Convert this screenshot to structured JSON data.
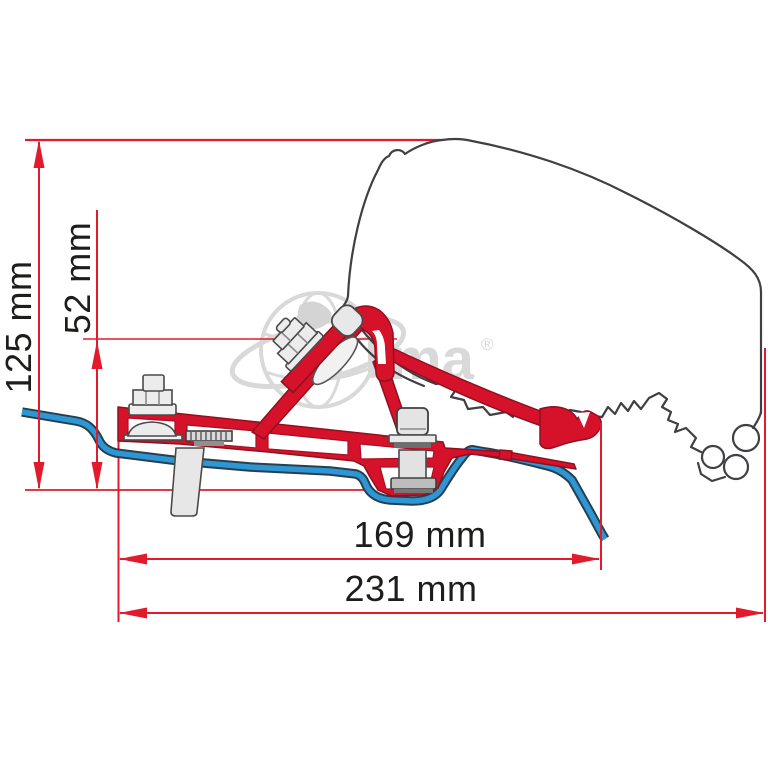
{
  "diagram": {
    "title": "awning-adapter-installation-drawing",
    "dimensions": [
      {
        "id": "overall-height",
        "label": "125 mm",
        "value": 125,
        "unit": "mm",
        "orientation": "vertical"
      },
      {
        "id": "bracket-height",
        "label": "52 mm",
        "value": 52,
        "unit": "mm",
        "orientation": "vertical"
      },
      {
        "id": "bracket-width",
        "label": "169 mm",
        "value": 169,
        "unit": "mm",
        "orientation": "horizontal"
      },
      {
        "id": "overall-width",
        "label": "231 mm",
        "value": 231,
        "unit": "mm",
        "orientation": "horizontal"
      }
    ],
    "colors": {
      "bracket_red": "#d6122b",
      "bracket_red_outline": "#90101f",
      "dimension_red": "#e11b2c",
      "roof_profile_blue": "#2e96d4",
      "roof_profile_outline": "#26404f",
      "vehicle_outline_gray": "#3f3f44",
      "metal_gray": "#ececec",
      "watermark_gray": "#d9d9d9"
    }
  },
  "watermark": {
    "brand_text": "ma",
    "registered_mark": "®"
  }
}
